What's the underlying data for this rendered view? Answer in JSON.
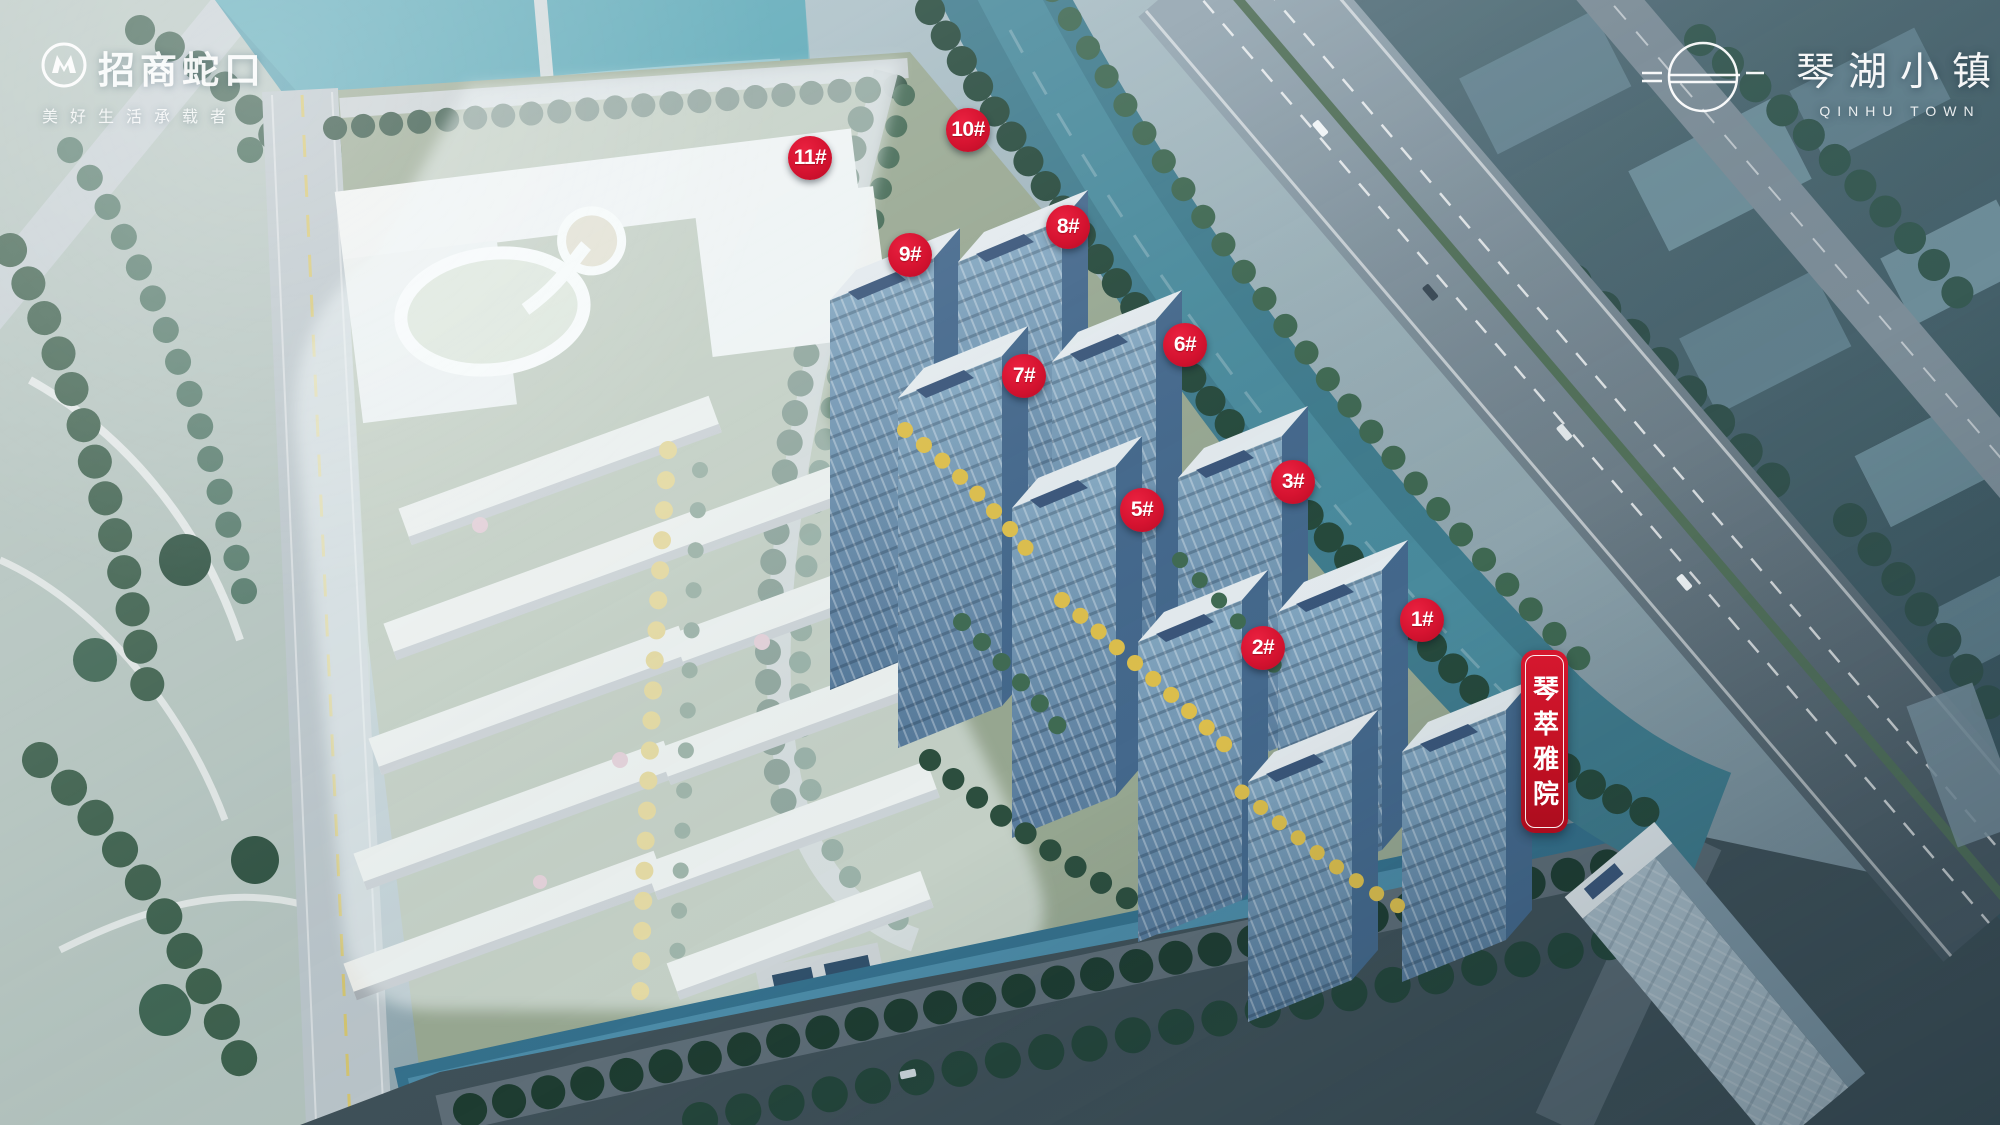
{
  "branding": {
    "developer": {
      "logo_icon": "cmsk-m-circle-icon",
      "name": "招商蛇口",
      "tagline": "美好生活承载者"
    },
    "project": {
      "logo_icon": "circle-horizon-lines-icon",
      "name_cn": "琴湖小镇",
      "name_en": "QINHU TOWN"
    }
  },
  "site_plan": {
    "description_visible_elements": "aerial rendering of residential development with numbered towers, ghosted low-rise parcel, rivers, highway",
    "zone_banner": {
      "text": "琴萃雅院"
    },
    "markers": [
      {
        "label": "1#",
        "x": 1422,
        "y": 620
      },
      {
        "label": "2#",
        "x": 1263,
        "y": 648
      },
      {
        "label": "3#",
        "x": 1293,
        "y": 482
      },
      {
        "label": "5#",
        "x": 1142,
        "y": 510
      },
      {
        "label": "6#",
        "x": 1185,
        "y": 345
      },
      {
        "label": "7#",
        "x": 1024,
        "y": 376
      },
      {
        "label": "8#",
        "x": 1068,
        "y": 227
      },
      {
        "label": "9#",
        "x": 910,
        "y": 255
      },
      {
        "label": "10#",
        "x": 968,
        "y": 130
      },
      {
        "label": "11#",
        "x": 810,
        "y": 158
      }
    ]
  },
  "colors": {
    "marker_red": "#d51330",
    "banner_red": "#c11023",
    "water_teal": "#3f7b8d",
    "tower_glass_blue": "#6d93b2",
    "autumn_tree_yellow": "#d9bb4a",
    "logo_white": "#ffffff"
  }
}
